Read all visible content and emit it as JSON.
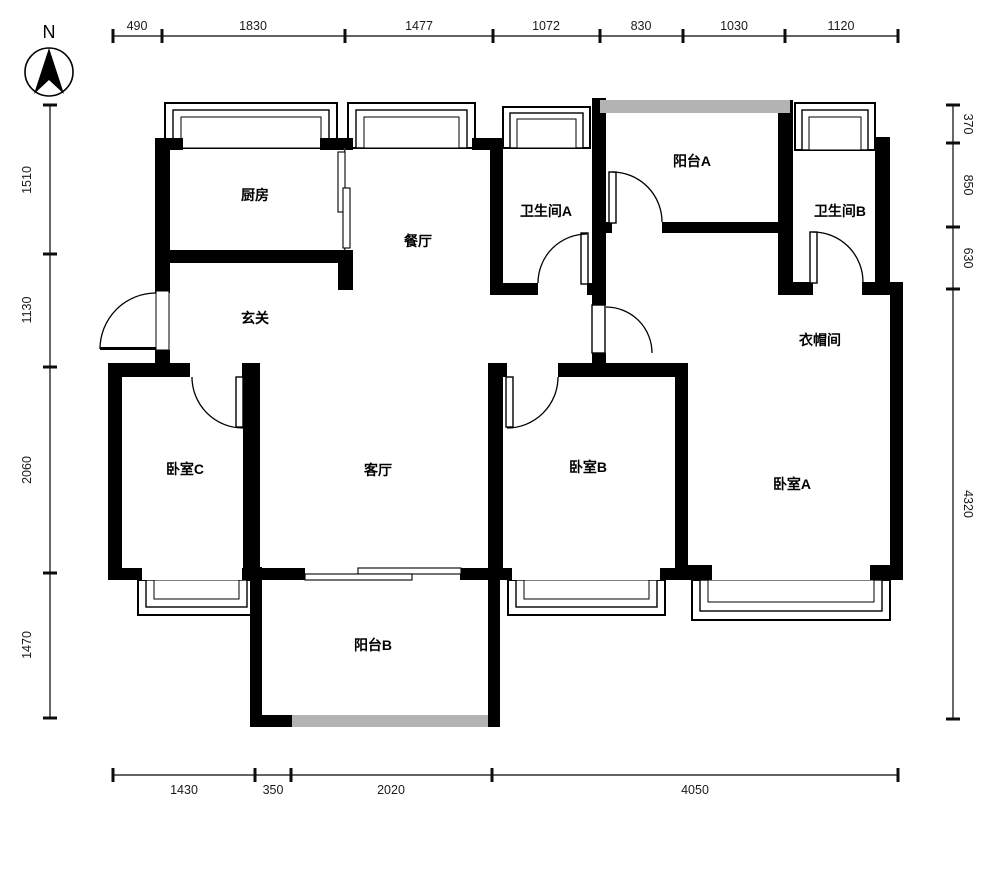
{
  "compass": {
    "north_label": "N"
  },
  "rooms": [
    {
      "id": "kitchen",
      "label": "厨房"
    },
    {
      "id": "dining",
      "label": "餐厅"
    },
    {
      "id": "bathroom-a",
      "label": "卫生间A"
    },
    {
      "id": "balcony-a",
      "label": "阳台A"
    },
    {
      "id": "bathroom-b",
      "label": "卫生间B"
    },
    {
      "id": "entry",
      "label": "玄关"
    },
    {
      "id": "cloakroom",
      "label": "衣帽间"
    },
    {
      "id": "bedroom-c",
      "label": "卧室C"
    },
    {
      "id": "living",
      "label": "客厅"
    },
    {
      "id": "bedroom-b",
      "label": "卧室B"
    },
    {
      "id": "bedroom-a",
      "label": "卧室A"
    },
    {
      "id": "balcony-b",
      "label": "阳台B"
    }
  ],
  "dimensions": {
    "top": [
      "490",
      "1830",
      "1477",
      "1072",
      "830",
      "1030",
      "1120"
    ],
    "left": [
      "1510",
      "1130",
      "2060",
      "1470"
    ],
    "right": [
      "370",
      "850",
      "630",
      "4320"
    ],
    "bottom": [
      "1430",
      "350",
      "2020",
      "4050"
    ]
  },
  "colors": {
    "wall": "#000000",
    "railing": "#b3b3b3",
    "dimension_line": "#4d4d4d",
    "background": "#ffffff"
  }
}
